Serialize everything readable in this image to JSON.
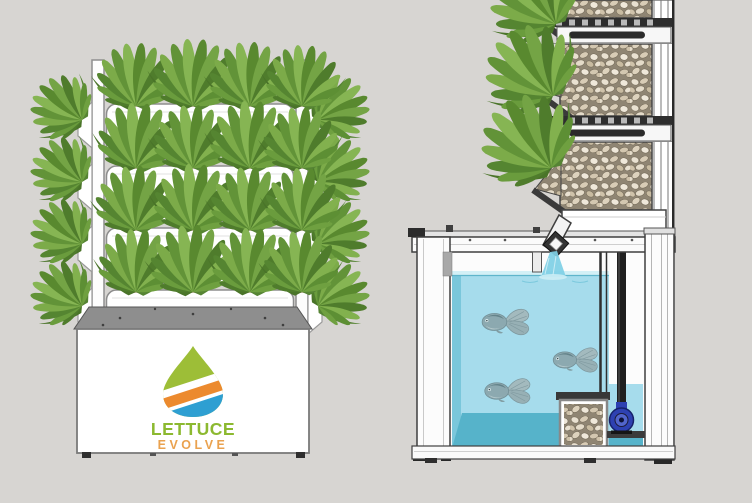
{
  "meta": {
    "description": "Lettuce Evolve aquaponics tower - product front view and cutaway cross-section",
    "view_left": "front view",
    "view_right": "cross-section"
  },
  "branding": {
    "line1": "LETTUCE",
    "line2": "EVOLVE",
    "line1_color": "#8cb930",
    "line2_color": "#eaa24f",
    "logo_colors": {
      "green": "#9dbe37",
      "orange": "#ec8a2e",
      "blue": "#2e9fd2"
    }
  },
  "left_unit": {
    "plant_rows": 4,
    "front_plants_per_row": 4,
    "side_plants_per_row": 2,
    "base_cabinet": true
  },
  "right_unit": {
    "grow_sections": 3,
    "plant_clusters": 3,
    "fish_count": 3,
    "components": [
      "grow media",
      "media grate",
      "water spout",
      "fish tank",
      "filter media box",
      "water pump",
      "standpipe"
    ]
  },
  "palette": {
    "background": "#d7d5d2",
    "frame_white": "#fbfbfb",
    "water_light": "#a6dcec",
    "water_wall": "#7ac7db",
    "water_floor": "#56b3ca",
    "water_surface": "#d3f0f6",
    "gravel_base": "#8f8573",
    "pump_blue": "#2e41b2",
    "plant_green": "#6a9c3d",
    "metal_dark": "#2e2e2e"
  }
}
